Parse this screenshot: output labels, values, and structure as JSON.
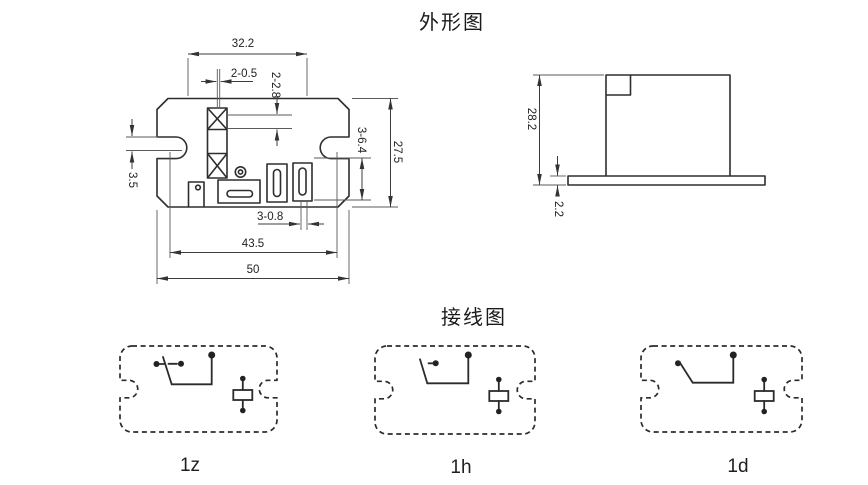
{
  "titles": {
    "outline": "外形图",
    "wiring": "接线图"
  },
  "colors": {
    "background": "#ffffff",
    "object_line": "#2e2e2e",
    "dimension_line": "#3c3c3c",
    "text": "#222222"
  },
  "front_view": {
    "dims": {
      "top_width": "32.2",
      "terminal_width": "2-0.5",
      "terminal_pitch": "2-2.8",
      "slot_offset": "3.5",
      "slot_length": "3-6.4",
      "body_height": "27.5",
      "slot_width": "3-0.8",
      "mounting_pitch": "43.5",
      "overall_width": "50"
    }
  },
  "side_view": {
    "dims": {
      "overall_height": "28.2",
      "flange_thickness": "2.2"
    }
  },
  "wiring": {
    "labels": [
      "1z",
      "1h",
      "1d"
    ]
  }
}
